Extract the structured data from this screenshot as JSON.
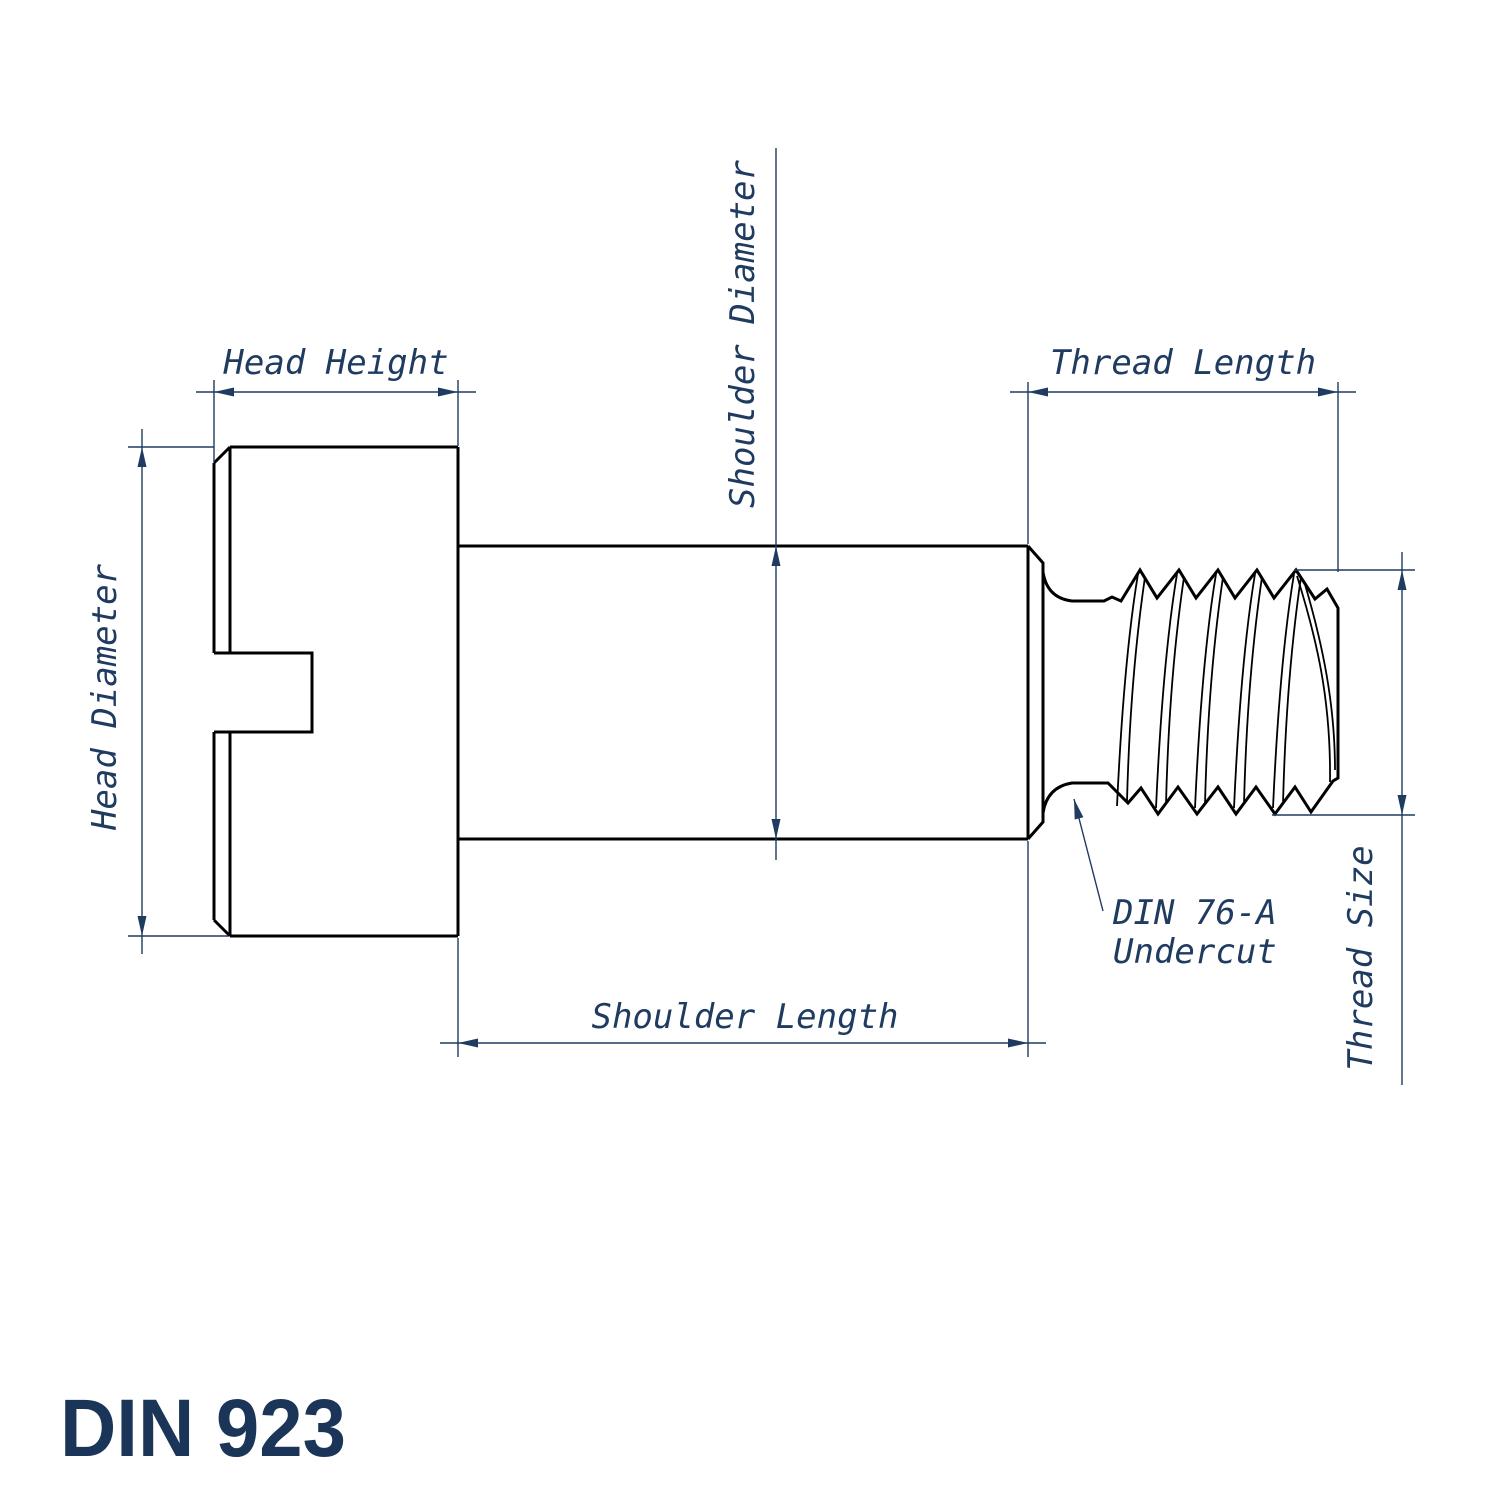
{
  "drawing": {
    "title": "DIN 923",
    "part_type": "slotted shoulder screw technical drawing",
    "labels": {
      "head_height": "Head Height",
      "head_diameter": "Head Diameter",
      "shoulder_diameter": "Shoulder Diameter",
      "thread_length": "Thread Length",
      "shoulder_length": "Shoulder Length",
      "thread_size": "Thread Size",
      "undercut_line1": "DIN 76-A",
      "undercut_line2": "Undercut"
    },
    "colors": {
      "outline": "#000000",
      "dimension": "#1f3b60",
      "title": "#1b3559",
      "background": "#ffffff"
    }
  }
}
